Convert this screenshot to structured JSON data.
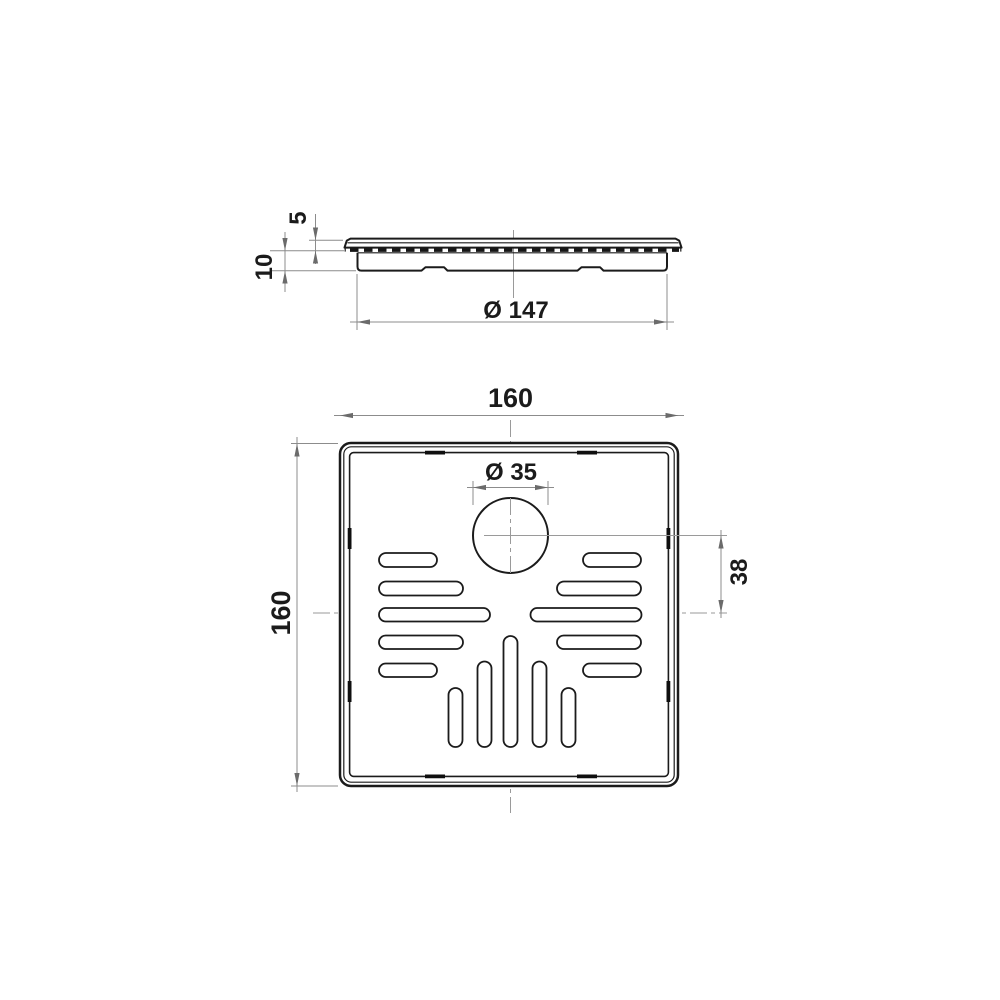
{
  "drawing": {
    "type": "technical-drawing",
    "views": [
      "side-view",
      "plan-view"
    ]
  },
  "dims": {
    "plate_thickness": "5",
    "body_depth": "10",
    "body_diameter": "Ø 147",
    "plan_width": "160",
    "plan_height": "160",
    "outlet_diameter": "Ø 35",
    "outlet_offset": "38"
  },
  "colors": {
    "background": "#ffffff",
    "outline": "#1b1b1b",
    "dimension_line": "#8c8c8c",
    "arrow": "#6b6b6b",
    "text": "#1b1b1b"
  }
}
